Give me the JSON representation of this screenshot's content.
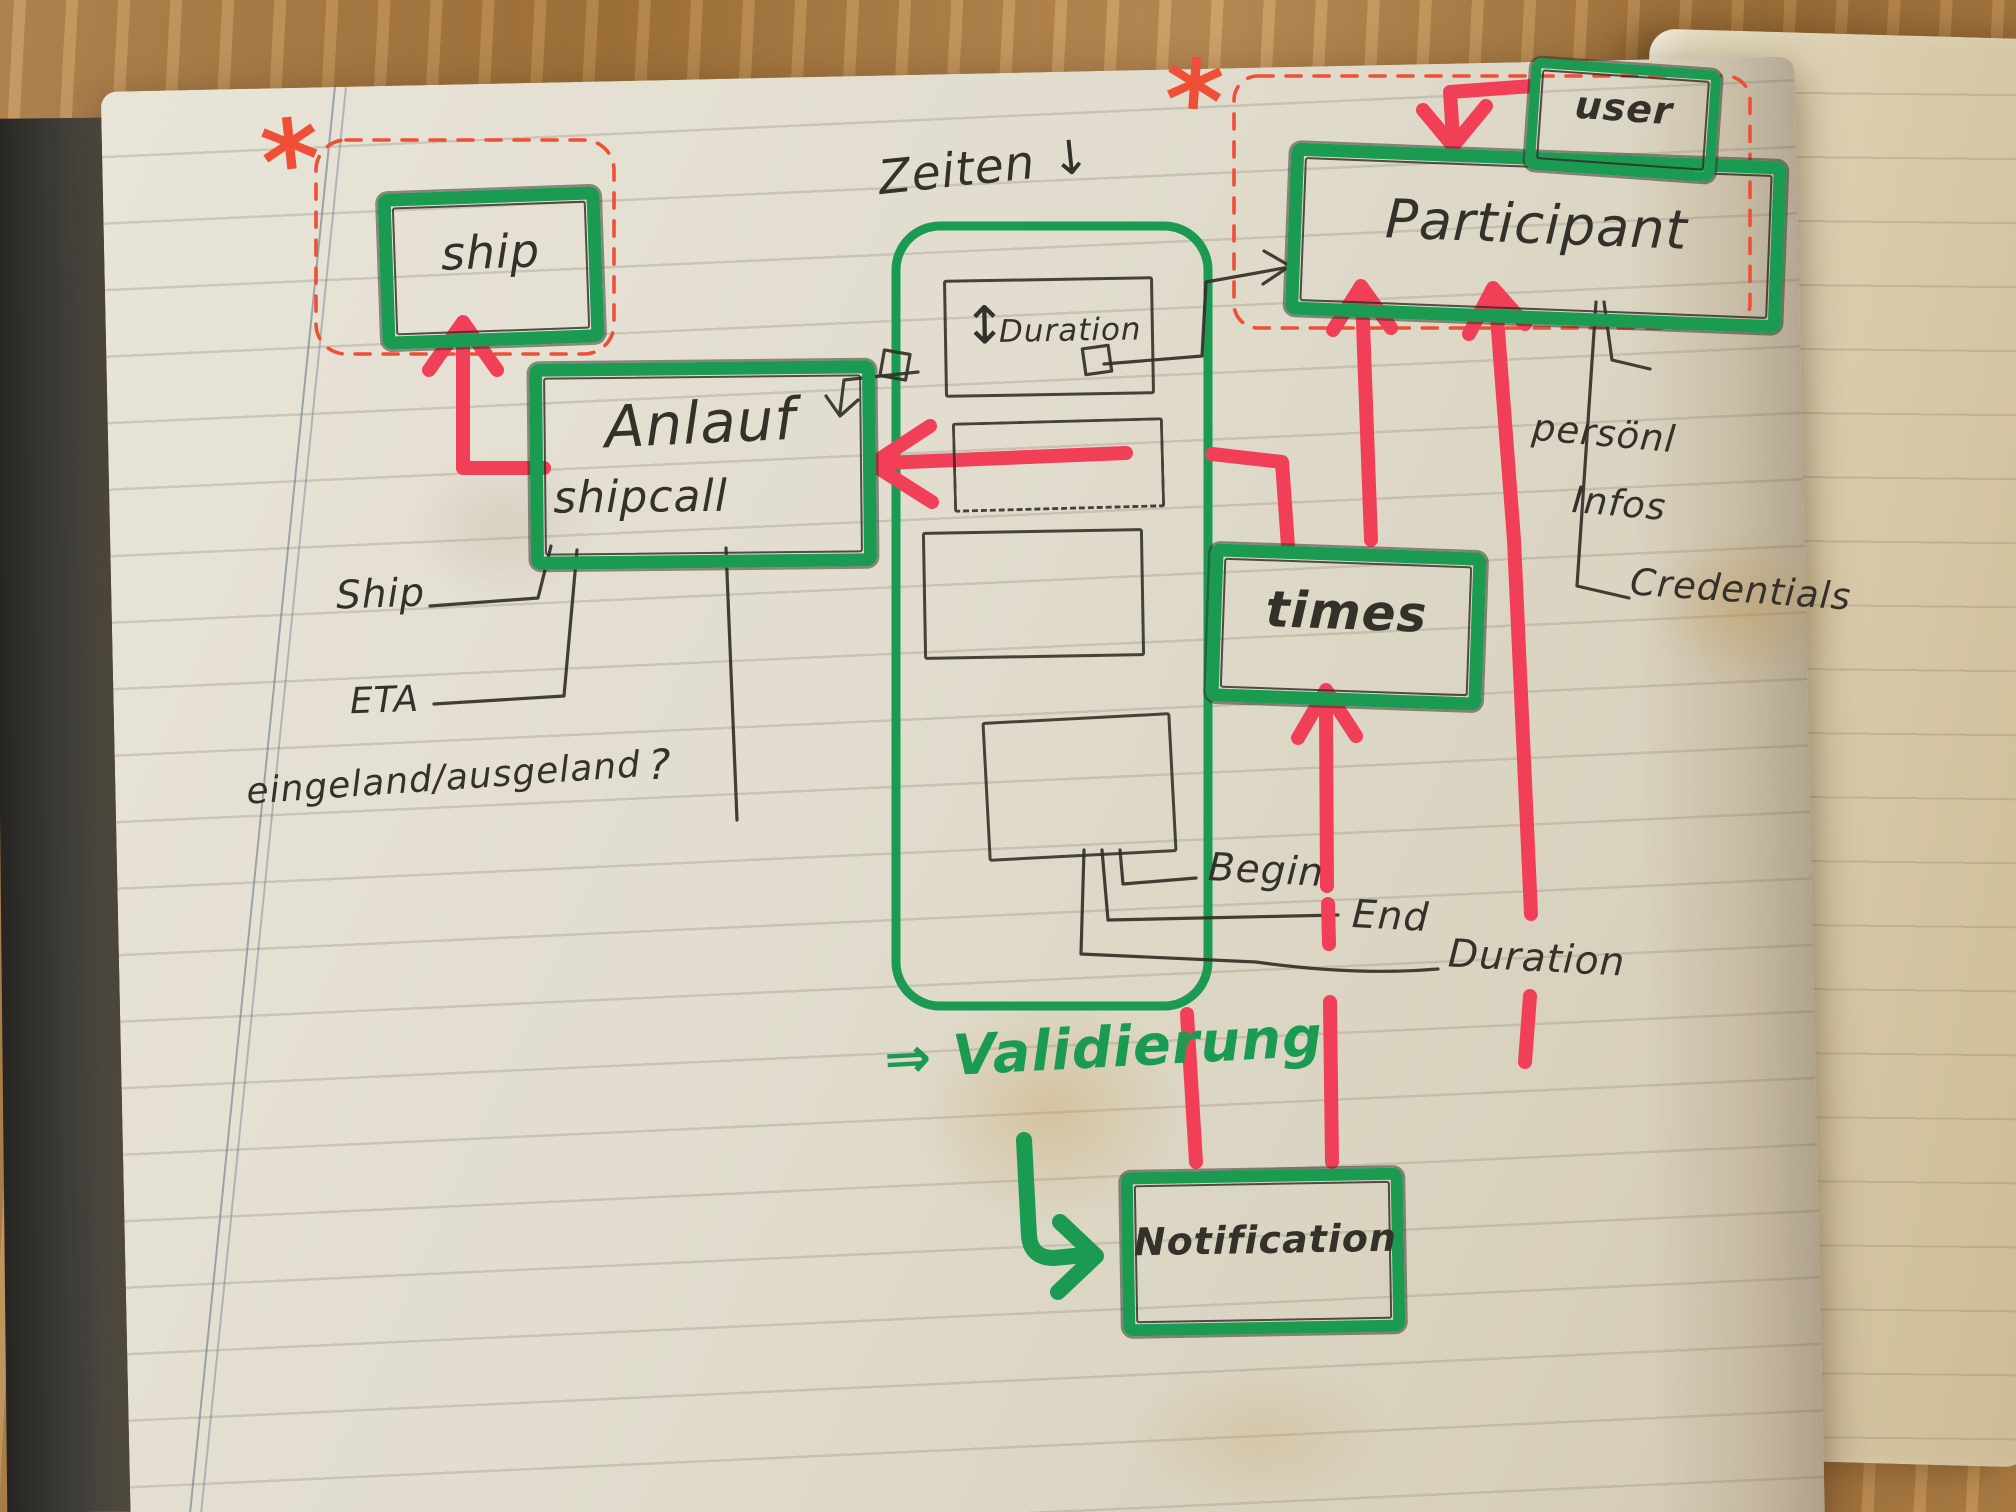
{
  "title": "Hand-drawn notebook data model sketch",
  "nodes": {
    "ship": {
      "label": "ship"
    },
    "shipcall": {
      "label": "Anlauf",
      "sublabel": "shipcall"
    },
    "participant": {
      "label": "Participant"
    },
    "user": {
      "label": "user"
    },
    "times": {
      "label": "times"
    },
    "notification": {
      "label": "Notification"
    },
    "duration": {
      "label": "Duration",
      "resize_icon": "↕"
    }
  },
  "attributes": {
    "zeiten": "Zeiten ↓",
    "ship": "Ship",
    "eta": "ETA",
    "in_out": "eingeland/ausgeland",
    "in_out_question": "?",
    "begin": "Begin",
    "end": "End",
    "duration": "Duration",
    "personal_line1": "persönl",
    "personal_line2": "Infos",
    "credentials": "Credentials"
  },
  "annotations": {
    "validation": "⇒ Validierung",
    "cardinality_marker": "*"
  },
  "relations": [
    {
      "from": "Anlauf (shipcall)",
      "to": "ship",
      "style": "red marker arrow"
    },
    {
      "from": "user",
      "to": "Participant",
      "style": "red marker arrow"
    },
    {
      "from": "times",
      "to": "Anlauf (shipcall)",
      "style": "red marker arrow, dashed"
    },
    {
      "from": "times",
      "to": "Participant",
      "style": "red marker arrow"
    },
    {
      "from": "Notification",
      "to": "times",
      "style": "red marker arrow"
    },
    {
      "from": "Notification",
      "to": "Participant",
      "style": "red marker arrow"
    },
    {
      "from": "Duration",
      "to": "Anlauf (shipcall)",
      "style": "pen arrow"
    },
    {
      "from": "Zeiten group",
      "to": "Participant",
      "style": "pen arrow"
    },
    {
      "from": "Validierung",
      "to": "Notification",
      "style": "green marker arrow"
    }
  ],
  "colors": {
    "marker_green": "#1b9a52",
    "marker_red": "#f23f58",
    "dashed_red": "#ee4f36",
    "pen": "#34302a",
    "page": "#e2ddcd",
    "wood": "#b3824a"
  }
}
